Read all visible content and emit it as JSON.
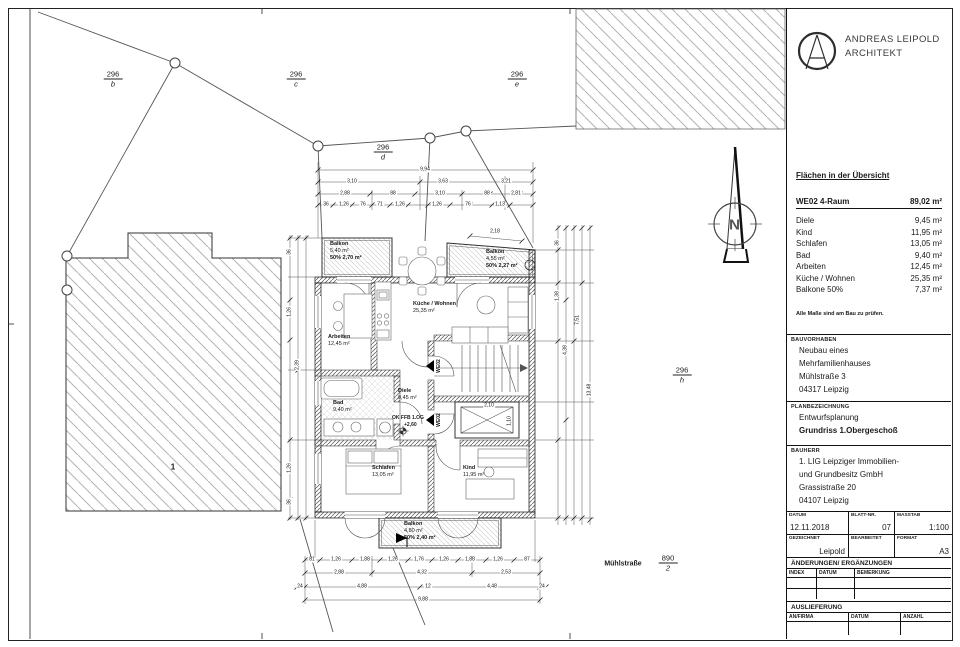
{
  "architect": {
    "name": "ANDREAS LEIPOLD",
    "title": "ARCHITEKT"
  },
  "areas": {
    "heading": "Flächen in der Übersicht",
    "unit": {
      "label": "WE02 4-Raum",
      "value": "89,02 m²"
    },
    "rows": [
      {
        "label": "Diele",
        "value": "9,45 m²"
      },
      {
        "label": "Kind",
        "value": "11,95 m²"
      },
      {
        "label": "Schlafen",
        "value": "13,05 m²"
      },
      {
        "label": "Bad",
        "value": "9,40 m²"
      },
      {
        "label": "Arbeiten",
        "value": "12,45 m²"
      },
      {
        "label": "Küche / Wohnen",
        "value": "25,35 m²"
      },
      {
        "label": "Balkone 50%",
        "value": "7,37 m²"
      }
    ],
    "note": "Alle Maße sind am Bau zu prüfen."
  },
  "project": {
    "bauvorhaben_label": "BAUVORHABEN",
    "bauvorhaben": [
      "Neubau eines",
      "Mehrfamilienhauses",
      "Mühlstraße 3",
      "04317 Leipzig"
    ],
    "planbezeichnung_label": "PLANBEZEICHNUNG",
    "plan_phase": "Entwurfsplanung",
    "plan_name": "Grundriss 1.Obergeschoß",
    "bauherr_label": "BAUHERR",
    "bauherr": [
      "1. LIG Leipziger Immobilien-",
      "und Grundbesitz GmbH",
      "Grassistraße 20",
      "04107 Leipzig"
    ]
  },
  "stamp": {
    "datum_label": "DATUM",
    "datum": "12.11.2018",
    "blatt_label": "BLATT-NR.",
    "blatt": "07",
    "massstab_label": "MASSTAB",
    "massstab": "1:100",
    "gezeichnet_label": "GEZEICHNET",
    "gezeichnet": "Leipold",
    "bearbeitet_label": "BEARBEITET",
    "bearbeitet": "",
    "format_label": "FORMAT",
    "format": "A3"
  },
  "revisions": {
    "heading": "ÄNDERUNGEN/ ERGÄNZUNGEN",
    "col1": "INDEX",
    "col2": "DATUM",
    "col3": "BEMERKUNG"
  },
  "delivery": {
    "heading": "AUSLIEFERUNG",
    "col1": "AN/FIRMA",
    "col2": "DATUM",
    "col3": "ANZAHL"
  },
  "site": {
    "parcels": {
      "b": {
        "num": "296",
        "sub": "b"
      },
      "c": {
        "num": "296",
        "sub": "c"
      },
      "e": {
        "num": "296",
        "sub": "e"
      },
      "d": {
        "num": "296",
        "sub": "d"
      },
      "h": {
        "num": "296",
        "sub": "h"
      },
      "street_parcel": {
        "num": "890",
        "sub": "2"
      }
    },
    "street": "Mühlstraße",
    "neighbor_house": "1",
    "north_label": "N"
  },
  "rooms": {
    "balkon_tl": {
      "name": "Balkon",
      "area": "5,40 m²",
      "extra": "50% 2,70 m²"
    },
    "balkon_tr": {
      "name": "Balkon",
      "area": "4,55 m²",
      "extra": "50% 2,27 m²"
    },
    "balkon_b": {
      "name": "Balkon",
      "area": "4,80 m²",
      "extra": "50% 2,40 m²"
    },
    "arbeiten": {
      "name": "Arbeiten",
      "area": "12,45 m²"
    },
    "kueche": {
      "name": "Küche / Wohnen",
      "area": "25,35 m²"
    },
    "bad": {
      "name": "Bad",
      "area": "9,40 m²"
    },
    "diele": {
      "name": "Diele",
      "area": "9,45 m²"
    },
    "schlafen": {
      "name": "Schlafen",
      "area": "13,05 m²"
    },
    "kind": {
      "name": "Kind",
      "area": "11,95 m²"
    }
  },
  "marks": {
    "level_line1": "OK FFB 1.OG",
    "level_line2": "+2,60",
    "door_tag1": "WE02",
    "door_tag2": "WE02"
  },
  "dims": {
    "top_total": "9,94",
    "top_row3": [
      "3,10",
      "3,63",
      "3,21"
    ],
    "top_row2": [
      "2,88",
      "88",
      "3,10",
      "88",
      "2,81"
    ],
    "top_row1": [
      "36",
      "1,26",
      "76",
      "71",
      "1,26",
      "1,26",
      "76",
      "1,13"
    ],
    "tr_balcony": "2,18",
    "bottom_row1": [
      "81",
      "1,26",
      "1,88",
      "1,26",
      "1,76",
      "1,26",
      "1,88",
      "1,26",
      "87"
    ],
    "bottom_row2": [
      "2,88",
      "4,32",
      "2,53"
    ],
    "bottom_row3": [
      "24",
      "4,88",
      "12",
      "4,48",
      "24"
    ],
    "bottom_total": "9,88",
    "left": [
      "36",
      "1,26",
      "2,39",
      "1,26",
      "36"
    ],
    "right": [
      "36",
      "1,38",
      "4,38",
      "7,51",
      "13,48"
    ],
    "lift_w": "2,10",
    "lift_h": "1,10"
  }
}
